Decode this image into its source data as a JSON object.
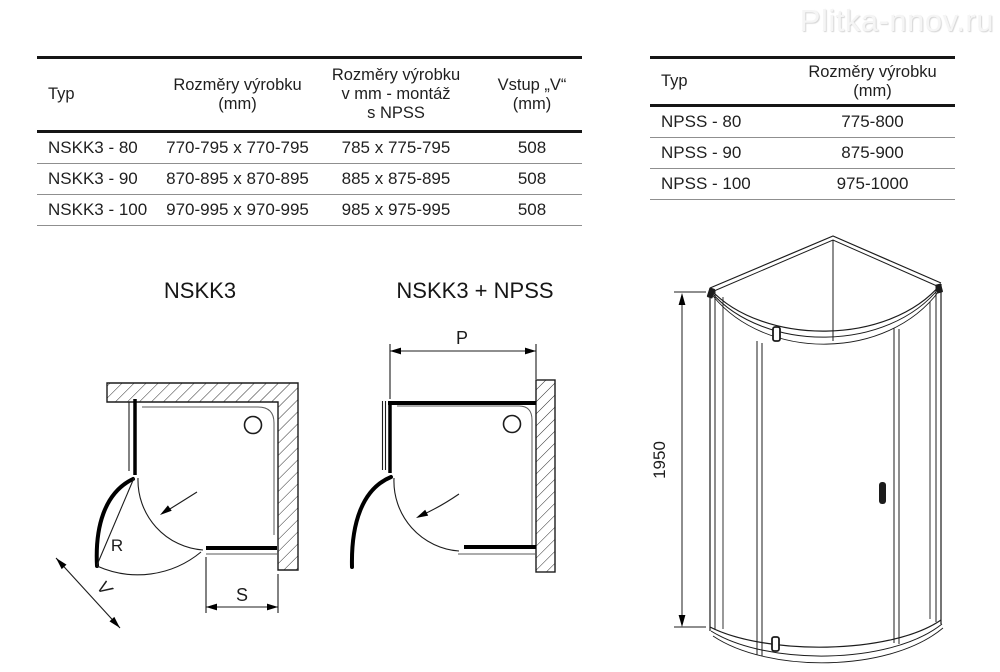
{
  "watermark": "Plitka-nnov.ru",
  "left_table": {
    "headers": [
      "Typ",
      "Rozměry výrobku\n(mm)",
      "Rozměry výrobku\nv mm - montáž\ns NPSS",
      "Vstup „V“\n(mm)"
    ],
    "rows": [
      [
        "NSKK3 - 80",
        "770-795 x 770-795",
        "785 x 775-795",
        "508"
      ],
      [
        "NSKK3 - 90",
        "870-895 x 870-895",
        "885 x 875-895",
        "508"
      ],
      [
        "NSKK3 - 100",
        "970-995 x 970-995",
        "985 x 975-995",
        "508"
      ]
    ]
  },
  "right_table": {
    "headers": [
      "Typ",
      "Rozměry výrobku\n(mm)"
    ],
    "rows": [
      [
        "NPSS - 80",
        "775-800"
      ],
      [
        "NPSS - 90",
        "875-900"
      ],
      [
        "NPSS - 100",
        "975-1000"
      ]
    ]
  },
  "diagrams": {
    "left_label": "NSKK3",
    "middle_label": "NSKK3 + NPSS",
    "dim_radius": "R",
    "dim_entry": "V",
    "dim_s": "S",
    "dim_p": "P",
    "dim_height": "1950"
  },
  "colors": {
    "line": "#1c1c1c",
    "table_border": "#161616",
    "row_divider": "#8f8f8f",
    "watermark": "#f5f5f5"
  }
}
